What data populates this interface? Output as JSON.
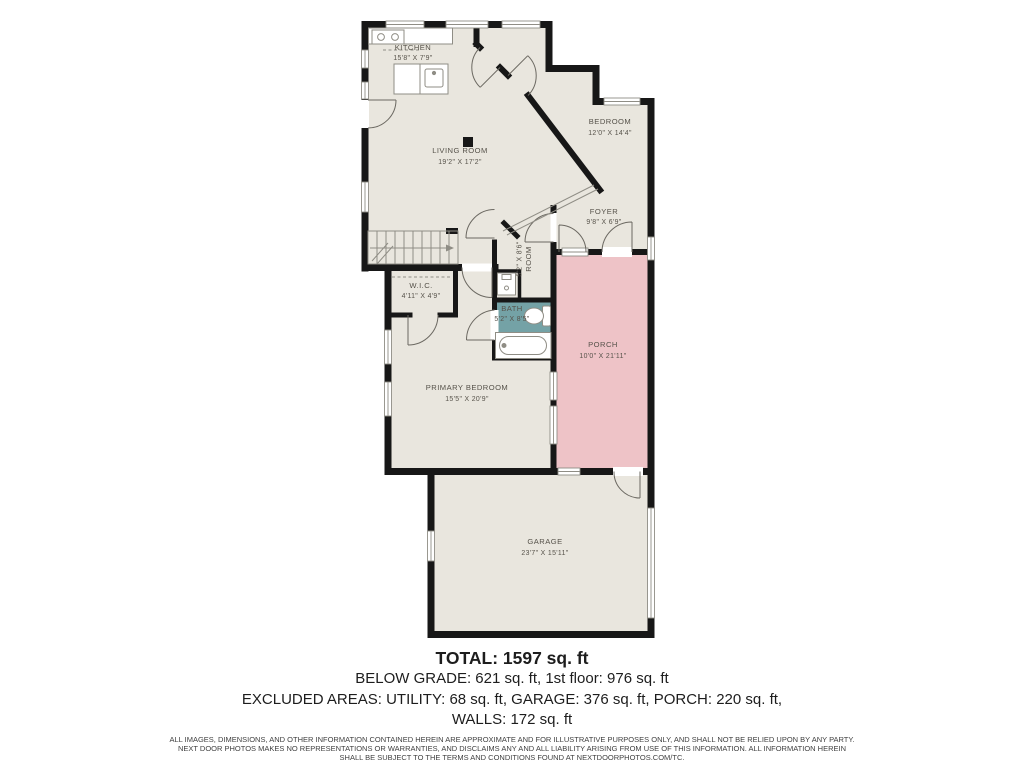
{
  "page": {
    "type": "floor-plan"
  },
  "colors": {
    "background": "#ffffff",
    "floor": "#e9e6de",
    "wall": "#171717",
    "porch_fill": "#eec3c7",
    "bath_fill": "#74a2a6",
    "fixture_line": "#8f8d85",
    "label_text": "#56524a"
  },
  "rooms": {
    "kitchen": {
      "name": "KITCHEN",
      "dims": "15'8\" X 7'9\""
    },
    "living_room": {
      "name": "LIVING ROOM",
      "dims": "19'2\" X 17'2\""
    },
    "bedroom": {
      "name": "BEDROOM",
      "dims": "12'0\" X 14'4\""
    },
    "foyer": {
      "name": "FOYER",
      "dims": "9'8\" X 6'9\""
    },
    "room": {
      "name": "ROOM",
      "dims": "5'2\" X 8'6\""
    },
    "wic": {
      "name": "W.I.C.",
      "dims": "4'11\" X 4'9\""
    },
    "bath": {
      "name": "BATH",
      "dims": "5'2\" X 8'5\""
    },
    "primary_bedroom": {
      "name": "PRIMARY BEDROOM",
      "dims": "15'5\" X 20'9\""
    },
    "porch": {
      "name": "PORCH",
      "dims": "10'0\" X 21'11\""
    },
    "garage": {
      "name": "GARAGE",
      "dims": "23'7\" X 15'11\""
    }
  },
  "summary": {
    "total": "TOTAL: 1597 sq. ft",
    "below_grade": "BELOW GRADE: 621 sq. ft, 1st floor: 976 sq. ft",
    "excluded": "EXCLUDED AREAS: UTILITY: 68 sq. ft, GARAGE: 376 sq. ft, PORCH: 220 sq. ft,",
    "walls": "WALLS: 172 sq. ft"
  },
  "disclaimer": {
    "line1": "ALL IMAGES, DIMENSIONS, AND OTHER INFORMATION CONTAINED HEREIN ARE APPROXIMATE AND FOR ILLUSTRATIVE PURPOSES ONLY, AND SHALL NOT BE RELIED UPON BY ANY PARTY.",
    "line2": "NEXT DOOR PHOTOS MAKES NO REPRESENTATIONS OR WARRANTIES, AND DISCLAIMS ANY AND ALL LIABILITY ARISING FROM USE OF THIS INFORMATION. ALL INFORMATION HEREIN",
    "line3": "SHALL BE SUBJECT TO THE TERMS AND CONDITIONS FOUND AT NEXTDOORPHOTOS.COM/TC."
  }
}
